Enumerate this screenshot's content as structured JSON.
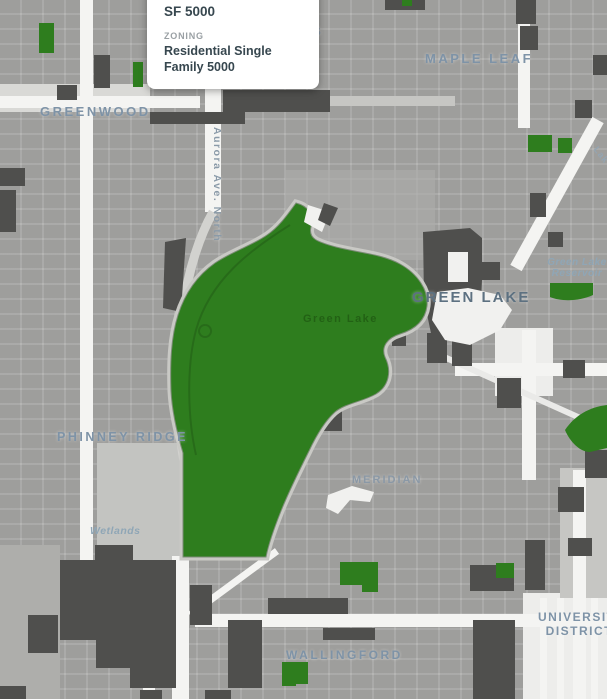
{
  "popup": {
    "title": "SF 5000",
    "field_label": "ZONING",
    "field_value": "Residential Single Family 5000"
  },
  "map": {
    "labels": {
      "licton_springs_partial": "GS",
      "greenwood": "GREENWOOD",
      "maple_leaf": "MAPLE LEAF",
      "aurora_ave": "Aurora Ave. North",
      "green_lake": "GREEN LAKE",
      "green_lake_reservoir": "Green Lake Reservoir",
      "green_lake_faint": "Green Lake",
      "lake_city_partial": "Lak",
      "phinney_ridge": "PHINNEY RIDGE",
      "meridian": "MERIDIAN",
      "wetlands": "Wetlands",
      "university_district": "UNIVERSITY DISTRICT",
      "wallingford": "WALLINGFORD"
    },
    "legend_semantics": {
      "park_green_areas": "Parks / open space",
      "dark_gray_areas": "Commercial / neighborhood commercial zoning",
      "gray_base": "Residential single family zoning"
    },
    "colors": {
      "park_green": "#2e7d1e",
      "zone_dark": "#4f4f4d",
      "base_gray": "#9e9e9c",
      "road_white": "#f4f4f2",
      "label_blue": "#7e93a7",
      "popup_text": "#37474f"
    }
  }
}
